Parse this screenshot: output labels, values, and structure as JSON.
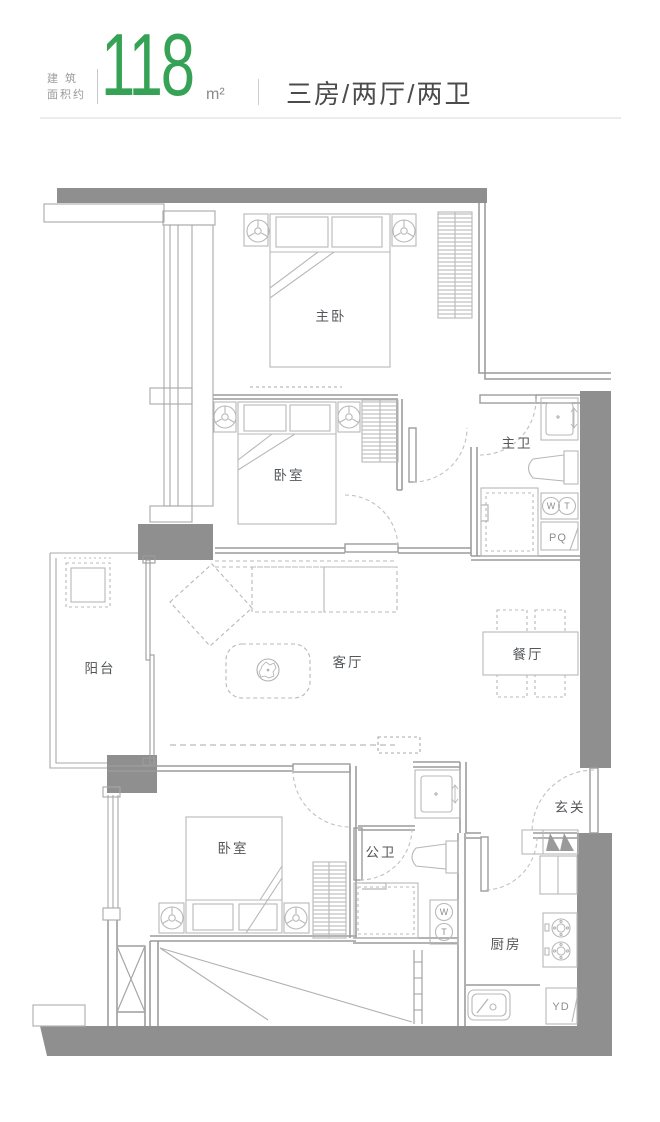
{
  "header": {
    "area_label_line1": "建 筑",
    "area_label_line2": "面积约",
    "area_value": "118",
    "area_unit": "m²",
    "separator": "|",
    "layout_text": "三房/两厅/两卫",
    "accent_color": "#36a255"
  },
  "floorplan": {
    "wall_color": "#8f8f8f",
    "rooms": [
      {
        "id": "master-bedroom",
        "label": "主卧"
      },
      {
        "id": "bedroom-2",
        "label": "卧室"
      },
      {
        "id": "master-bath",
        "label": "主卫"
      },
      {
        "id": "balcony",
        "label": "阳台"
      },
      {
        "id": "living-room",
        "label": "客厅"
      },
      {
        "id": "dining-room",
        "label": "餐厅"
      },
      {
        "id": "bedroom-3",
        "label": "卧室"
      },
      {
        "id": "guest-bath",
        "label": "公卫"
      },
      {
        "id": "entry",
        "label": "玄关"
      },
      {
        "id": "kitchen",
        "label": "厨房"
      }
    ],
    "appliances": {
      "washer_label": "W",
      "dryer_label": "T",
      "pq_label": "PQ",
      "yd_label": "YD"
    }
  }
}
